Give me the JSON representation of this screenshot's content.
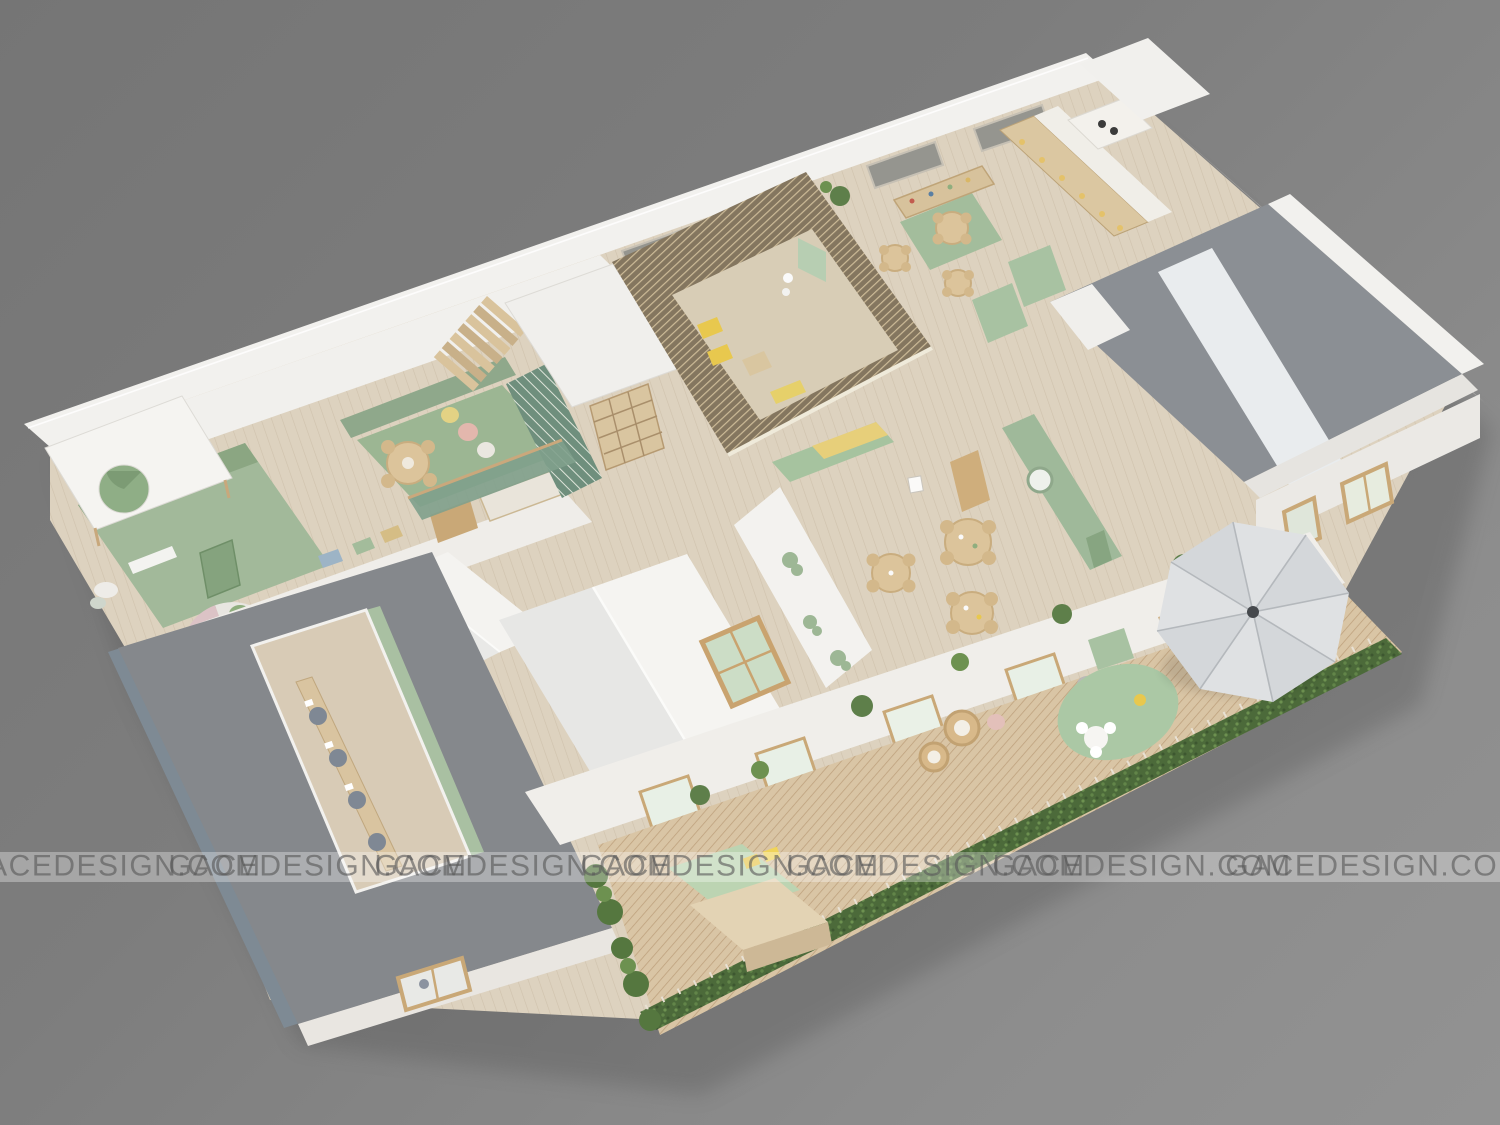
{
  "watermark": {
    "text": "GACEDESIGN.COM",
    "items": [
      "GACEDESIGN.COM",
      "GACEDESIGN.COM",
      "GACEDESIGN.COM",
      "GACEDESIGN.COM",
      "GACEDESIGN.COM",
      "GACEDESIGN.COM",
      "GACEDESIGN.COM"
    ]
  },
  "palette": {
    "bg_top": "#767676",
    "bg_bottom": "#8f8f8f",
    "wall_white": "#f2f1ee",
    "wall_shaded": "#e7e5e1",
    "roof_gray": "#8b8f94",
    "roof_dark": "#70757a",
    "roof_blue_gray": "#7e8a94",
    "floor_wood": "#ddd2bf",
    "atrium_floor": "#d8cdb6",
    "deck_wood": "#d9c5a5",
    "pergola_wood": "#84765f",
    "sage_wall": "#9fb99a",
    "sage_rug": "#9cb693",
    "sage_entry": "#a2b99a",
    "mint_cabinet": "#a6c39f",
    "hedge_green": "#4c6a3a",
    "plant_green": "#5e7f4a",
    "accent_yellow": "#e8c84e",
    "accent_pink": "#e3b7ad",
    "table_wood": "#dcc49b",
    "locker_wood": "#dbc7a1",
    "umbrella_gray": "#dfe1e3",
    "umbrella_gray2": "#d4d7da"
  }
}
